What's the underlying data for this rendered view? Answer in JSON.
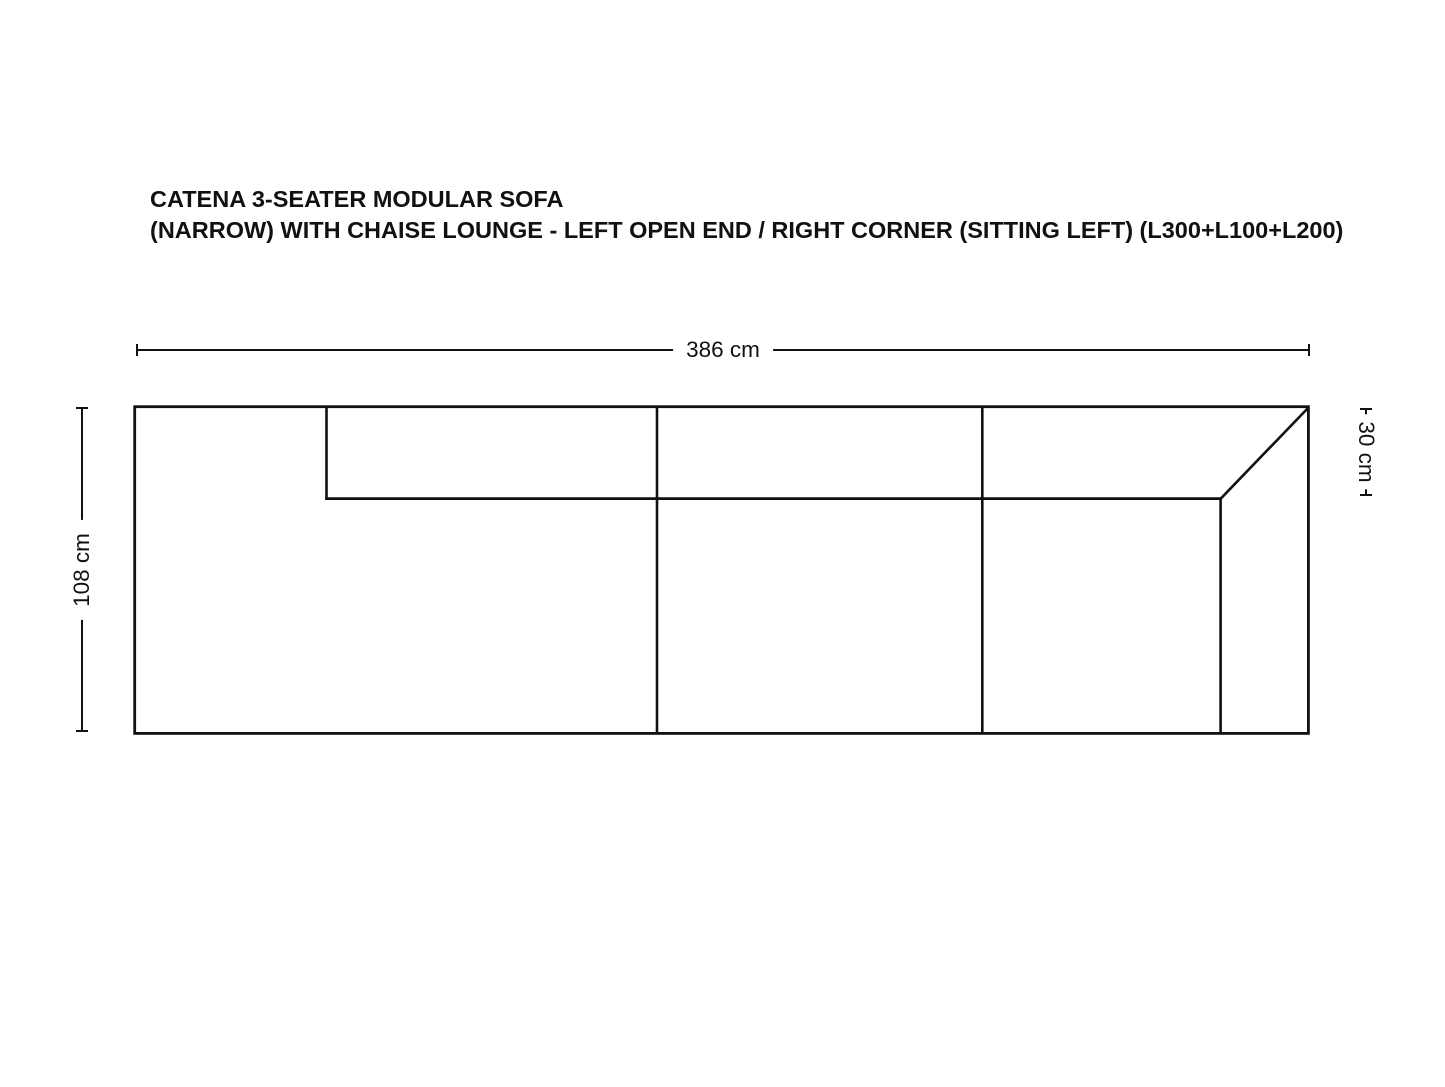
{
  "title": {
    "line1": "CATENA 3-SEATER MODULAR SOFA",
    "line2": "(NARROW) WITH CHAISE LOUNGE - LEFT OPEN END / RIGHT CORNER (SITTING LEFT) (L300+L100+L200)"
  },
  "dimensions": {
    "overall_width": {
      "label": "386 cm"
    },
    "overall_depth": {
      "label": "108 cm"
    },
    "backrest_depth": {
      "label": "30 cm"
    }
  },
  "diagram": {
    "description": "top-view sofa outline schematic",
    "line_color": "#111111",
    "background_color": "#ffffff",
    "modules": [
      "L300",
      "L100",
      "L200"
    ]
  }
}
